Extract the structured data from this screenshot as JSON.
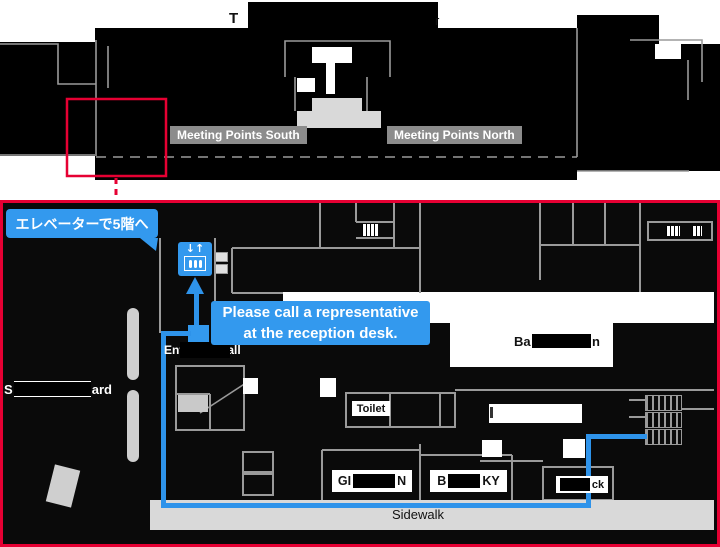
{
  "colors": {
    "accent_red": "#e60033",
    "accent_blue": "#3399ee",
    "route_blue": "#2e93ea",
    "line_gray": "#9a9a9a",
    "label_gray": "#8c8c8c",
    "light_gray": "#d9d9d9"
  },
  "overview": {
    "title": {
      "prefix": "T",
      "suffix": "r"
    },
    "meeting_point_south": "Meeting Points South",
    "meeting_point_north": "Meeting Points North"
  },
  "detail": {
    "elevator_callout": "エレベーターで5階へ",
    "reception_callout": {
      "line1": "Please call a representative",
      "line2": "at the reception desk."
    },
    "entrance_hall": "Entrance Hall",
    "toilet": "Toilet",
    "restaurant": {
      "prefix": "Ba",
      "suffix": "n"
    },
    "shop_left": {
      "prefix": "GI",
      "suffix": "N"
    },
    "shop_right": {
      "prefix": "B",
      "suffix": "KY"
    },
    "dock": {
      "suffix": "ck"
    },
    "road": {
      "prefix": "S",
      "suffix": "ard"
    },
    "sidewalk": "Sidewalk",
    "elevator_icon_arrows": "↓↑"
  }
}
